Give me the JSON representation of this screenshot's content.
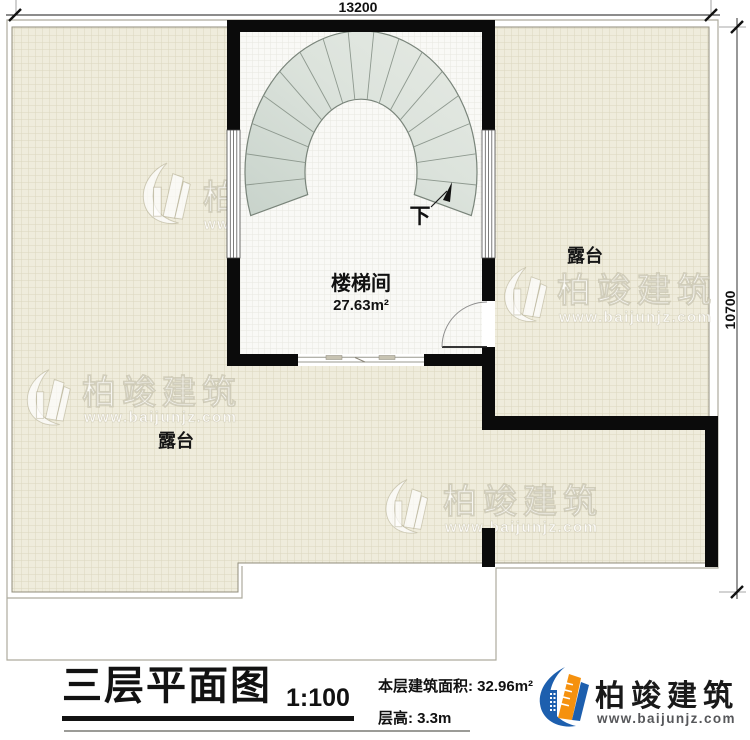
{
  "plan": {
    "dimensions": {
      "top": "13200",
      "right": "10700"
    },
    "stairwell": {
      "label": "楼梯间",
      "area": "27.63m²",
      "direction_label": "下"
    },
    "terraces": {
      "right_label": "露台",
      "left_label": "露台"
    }
  },
  "stair": {
    "cx": 361,
    "cy": 172,
    "outer_rx": 116,
    "outer_ry": 141,
    "inner_rx": 56,
    "inner_ry": 73,
    "start_deg": 162,
    "end_deg": 378,
    "treads": 17
  },
  "watermark": {
    "brand": "柏竣建筑",
    "website": "www.baijunjz.com"
  },
  "title_block": {
    "title": "三层平面图",
    "scale": "1:100",
    "area": "本层建筑面积: 32.96m²",
    "floor_height": "层高: 3.3m"
  },
  "logo": {
    "brand": "柏竣建筑",
    "website": "www.baijunjz.com"
  },
  "colors": {
    "terrace_fill": "#efecdc",
    "terrace_grid": "#dbd6be",
    "wall": "#0b0b0b",
    "stair_tread": "#dce3dc",
    "accent_blue": "#1d5fae",
    "accent_orange": "#f5910e"
  }
}
